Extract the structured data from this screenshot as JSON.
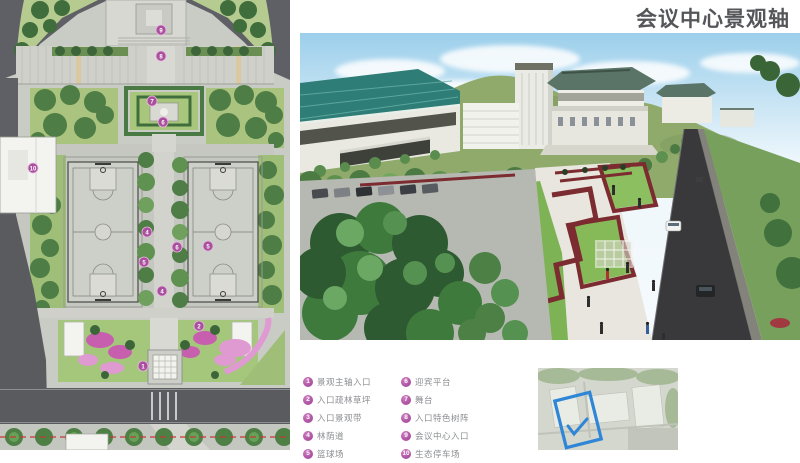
{
  "page": {
    "title": "会议中心景观轴"
  },
  "legend": {
    "left": [
      {
        "num": "1",
        "label": "景观主轴入口"
      },
      {
        "num": "2",
        "label": "入口疏林草坪"
      },
      {
        "num": "3",
        "label": "入口景观带"
      },
      {
        "num": "4",
        "label": "林荫道"
      },
      {
        "num": "5",
        "label": "篮球场"
      }
    ],
    "right": [
      {
        "num": "6",
        "label": "迎宾平台"
      },
      {
        "num": "7",
        "label": "舞台"
      },
      {
        "num": "8",
        "label": "入口特色树阵"
      },
      {
        "num": "9",
        "label": "会议中心入口"
      },
      {
        "num": "10",
        "label": "生态停车场"
      }
    ]
  },
  "plan": {
    "markers": [
      {
        "n": "9",
        "x": 161,
        "y": 30
      },
      {
        "n": "8",
        "x": 161,
        "y": 56
      },
      {
        "n": "7",
        "x": 152,
        "y": 101
      },
      {
        "n": "6",
        "x": 163,
        "y": 122
      },
      {
        "n": "10",
        "x": 33,
        "y": 168
      },
      {
        "n": "4",
        "x": 147,
        "y": 232
      },
      {
        "n": "6",
        "x": 177,
        "y": 247
      },
      {
        "n": "5",
        "x": 208,
        "y": 246
      },
      {
        "n": "5",
        "x": 144,
        "y": 262
      },
      {
        "n": "4",
        "x": 162,
        "y": 291
      },
      {
        "n": "2",
        "x": 199,
        "y": 326
      },
      {
        "n": "1",
        "x": 143,
        "y": 366
      }
    ]
  },
  "colors": {
    "accent_magenta": "#a94f9e",
    "title_gray": "#55565a",
    "legend_text": "#8b8d90",
    "keymap_blue": "#2f86d6",
    "roof_teal": "#2e7d76",
    "hedge_red": "#7c2b30"
  }
}
